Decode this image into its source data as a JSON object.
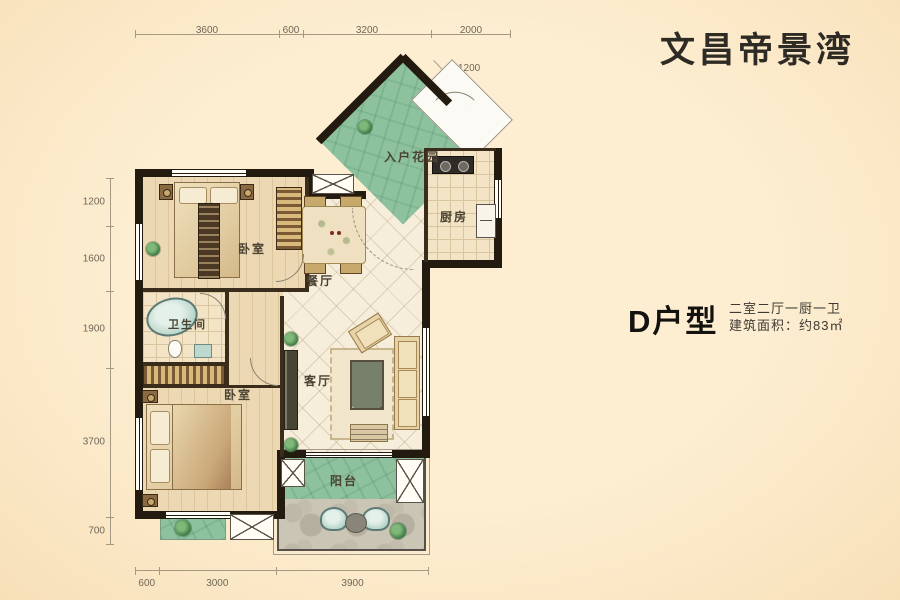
{
  "title": "文昌帝景湾",
  "unit": {
    "name": "D户型",
    "layout": "二室二厅一厨一卫",
    "area": "建筑面积：约83㎡"
  },
  "rooms": {
    "entry_garden": "入户花园",
    "kitchen": "厨房",
    "bedroom_top": "卧室",
    "dining": "餐厅",
    "bathroom": "卫生间",
    "living": "客厅",
    "bedroom_bottom": "卧室",
    "balcony": "阳台"
  },
  "dimensions": {
    "top": [
      "3600",
      "600",
      "3200",
      "2000"
    ],
    "left": [
      "1200",
      "1600",
      "1900",
      "3700",
      "700"
    ],
    "bottom": [
      "600",
      "3000",
      "3900"
    ],
    "diagonal": "1200"
  },
  "colors": {
    "background": "#fbe8ca",
    "wall": "#241b10",
    "garden_green": "#8ec29f",
    "title_text": "#2e2a24"
  }
}
